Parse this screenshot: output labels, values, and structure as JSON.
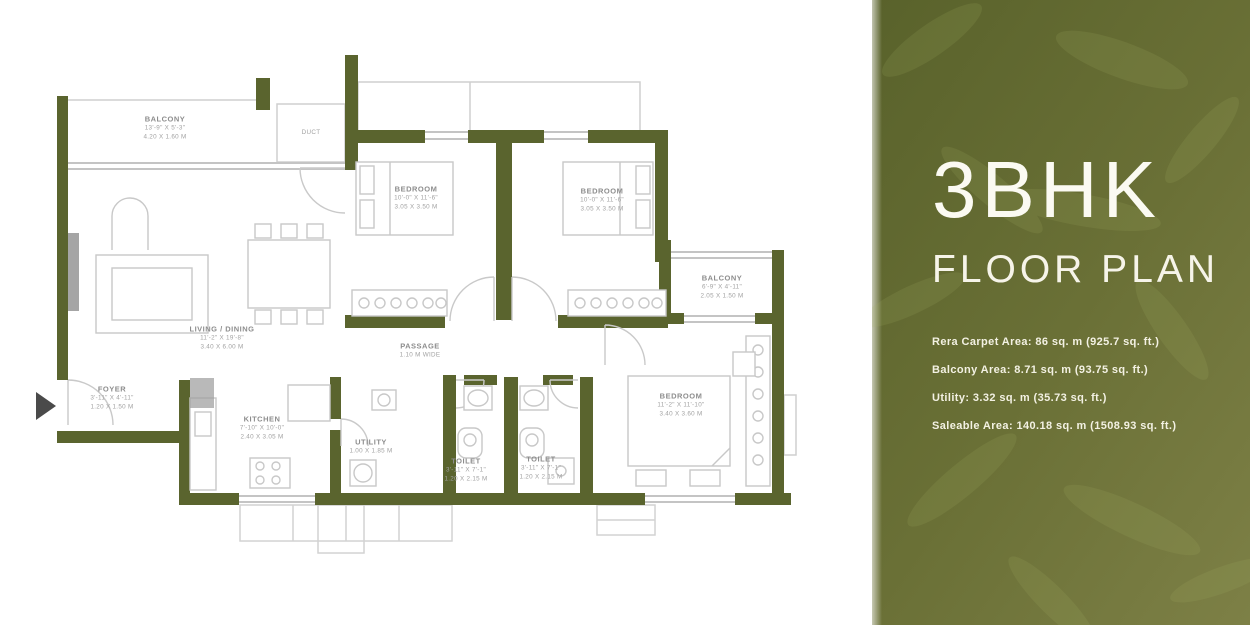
{
  "panel": {
    "title": "3BHK",
    "subtitle": "FLOOR PLAN",
    "details": [
      "Rera Carpet Area: 86 sq. m (925.7 sq. ft.)",
      "Balcony Area: 8.71 sq. m (93.75 sq. ft.)",
      "Utility: 3.32 sq. m (35.73 sq. ft.)",
      "Saleable Area: 140.18 sq. m (1508.93 sq. ft.)"
    ]
  },
  "floor_plan": {
    "rooms": [
      {
        "id": "balcony-top",
        "name": "BALCONY",
        "dim_ft": "13'-9\" X 5'-3\"",
        "dim_m": "4.20 X 1.60 M"
      },
      {
        "id": "duct",
        "name": "DUCT",
        "dim_ft": "",
        "dim_m": ""
      },
      {
        "id": "living-dining",
        "name": "LIVING / DINING",
        "dim_ft": "11'-2\" X 19'-8\"",
        "dim_m": "3.40 X 6.00 M"
      },
      {
        "id": "bedroom-1",
        "name": "BEDROOM",
        "dim_ft": "10'-0\" X 11'-6\"",
        "dim_m": "3.05 X 3.50 M"
      },
      {
        "id": "bedroom-2",
        "name": "BEDROOM",
        "dim_ft": "10'-0\" X 11'-6\"",
        "dim_m": "3.05 X 3.50 M"
      },
      {
        "id": "balcony-right",
        "name": "BALCONY",
        "dim_ft": "6'-9\" X 4'-11\"",
        "dim_m": "2.05 X 1.50 M"
      },
      {
        "id": "master-bedroom",
        "name": "BEDROOM",
        "dim_ft": "11'-2\" X 11'-10\"",
        "dim_m": "3.40 X 3.60 M"
      },
      {
        "id": "kitchen",
        "name": "KITCHEN",
        "dim_ft": "7'-10\" X 10'-0\"",
        "dim_m": "2.40 X 3.05 M"
      },
      {
        "id": "utility",
        "name": "UTILITY",
        "dim_ft": "3'-3\" X 6'-1\"",
        "dim_m": "1.00 X 1.85 M"
      },
      {
        "id": "toilet-1",
        "name": "TOILET",
        "dim_ft": "3'-11\" X 7'-1\"",
        "dim_m": "1.20 X 2.15 M"
      },
      {
        "id": "toilet-2",
        "name": "TOILET",
        "dim_ft": "3'-11\" X 7'-1\"",
        "dim_m": "1.20 X 2.15 M"
      },
      {
        "id": "foyer",
        "name": "FOYER",
        "dim_ft": "3'-11\" X 4'-11\"",
        "dim_m": "1.20 X 1.50 M"
      },
      {
        "id": "passage",
        "name": "PASSAGE",
        "dim_ft": "3'-7\" WIDE",
        "dim_m": "1.10 M WIDE"
      }
    ]
  },
  "colors": {
    "panel_green_dark": "#59622b",
    "panel_green_light": "#7d8046",
    "wall_green": "#5a642e",
    "plan_line_gray": "#c9c9c9",
    "label_gray": "#9a9a9a",
    "text_ivory": "#f7f5ea",
    "entry_arrow_gray": "#4a4a4a"
  }
}
